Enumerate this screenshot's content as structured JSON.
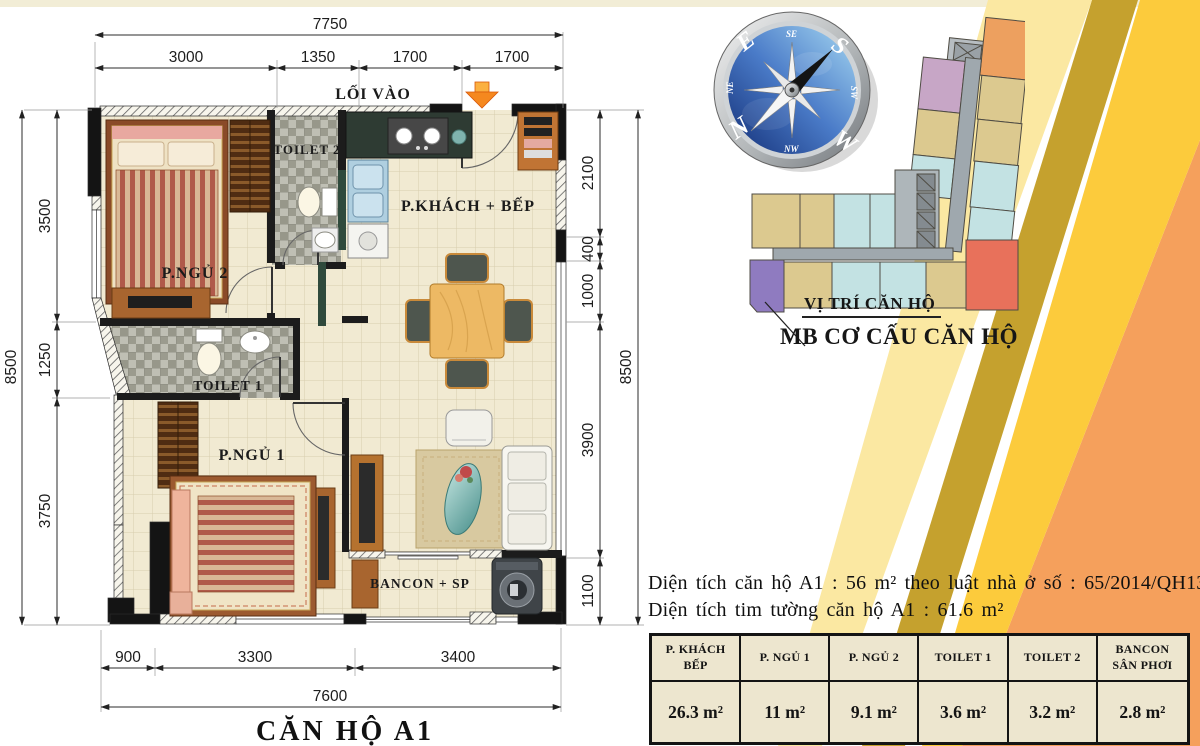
{
  "title": "CĂN HỘ A1",
  "plan": {
    "entrance_label": "LỐI VÀO",
    "rooms": {
      "bedroom2": "P.NGỦ 2",
      "toilet2": "TOILET 2",
      "living_kitchen": "P.KHÁCH + BẾP",
      "toilet1": "TOILET 1",
      "bedroom1": "P.NGỦ 1",
      "balcony": "BANCON + SP"
    }
  },
  "dims": {
    "top": {
      "total": "7750",
      "segments": [
        "3000",
        "1350",
        "1700",
        "1700"
      ]
    },
    "left": {
      "total": "8500",
      "segments": [
        "3500",
        "1250",
        "3750"
      ]
    },
    "right": {
      "total": "8500",
      "segments": [
        "2100",
        "400",
        "1000",
        "3900",
        "1100"
      ]
    },
    "bottom": {
      "total": "7600",
      "segments": [
        "900",
        "3300",
        "3400"
      ]
    }
  },
  "compass": {
    "n": "N",
    "e": "E",
    "s": "S",
    "w": "W",
    "ne": "NE",
    "se": "SE",
    "sw": "SW",
    "nw": "NW"
  },
  "site_map": {
    "pointer_label": "VỊ TRÍ CĂN HỘ",
    "caption": "MB CƠ CẤU CĂN HỘ"
  },
  "info": {
    "line1": "Diện tích căn hộ A1 : 56 m² theo luật nhà ở số : 65/2014/QH13",
    "line2": "Diện tích tim tường căn hộ A1 : 61.6 m²"
  },
  "area_table": {
    "headers": [
      "P. KHÁCH BẾP",
      "P. NGỦ 1",
      "P. NGỦ 2",
      "TOILET 1",
      "TOILET 2",
      "BANCON SÂN PHƠI"
    ],
    "values": [
      "26.3 m²",
      "11 m²",
      "9.1 m²",
      "3.6 m²",
      "3.2 m²",
      "2.8 m²"
    ]
  },
  "colors": {
    "stripe_cream": "#FBE8A2",
    "stripe_gold": "#C5A12E",
    "stripe_yellow": "#FCCB3C",
    "stripe_orange": "#F5A05C",
    "unit_highlight": "#8F7BC0"
  }
}
